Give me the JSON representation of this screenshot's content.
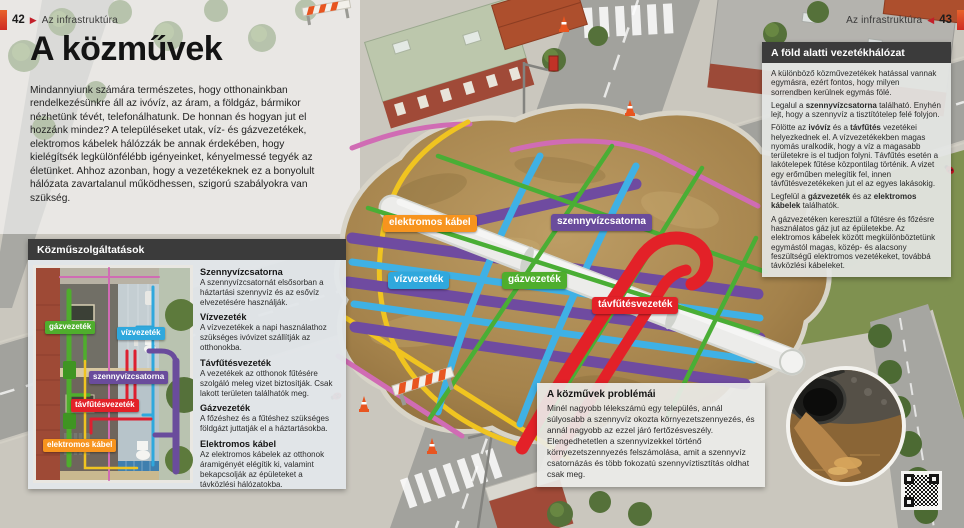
{
  "page": {
    "title": "A közművek",
    "intro": "Mindannyiunk számára természetes, hogy otthonainkban rendelkezésünkre áll az ivóvíz, az áram, a földgáz, bármikor nézhetünk tévét, telefonálhatunk. De honnan és hogyan jut el hozzánk mindez? A településeket utak, víz- és gázvezetékek, elektromos kábelek hálózzák be annak érdekében, hogy kielégítsék legkülönfélébb igényeinket, kényelmessé tegyék az életünket. Ahhoz azonban, hogy a vezetékeknek ez a bonyolult hálózata zavartalanul működhessen, szigorú szabályokra van szükség."
  },
  "header_left": {
    "page_number": "42",
    "section": "Az infrastruktúra"
  },
  "header_right": {
    "section": "Az infrastruktúra",
    "page_number": "43"
  },
  "services_box": {
    "header": "Közműszolgáltatások",
    "house_labels": [
      "gázvezeték",
      "vízvezeték",
      "szennyvízcsatorna",
      "távfűtésvezeték",
      "elektromos kábel"
    ],
    "entries": [
      {
        "term": "Szennyvízcsatorna",
        "description": "A szennyvízcsatornát elsősorban a háztartási szennyvíz és az esővíz elvezetésére használják."
      },
      {
        "term": "Vízvezeték",
        "description": "A vízvezetékek a napi használathoz szükséges ivóvizet szállítják az otthonokba."
      },
      {
        "term": "Távfűtésvezeték",
        "description": "A vezetékek az otthonok fűtésére szolgáló meleg vizet biztosítják. Csak lakott területen találhatók meg."
      },
      {
        "term": "Gázvezeték",
        "description": "A főzéshez és a fűtéshez szükséges földgázt juttatják el a háztartásokba."
      },
      {
        "term": "Elektromos kábel",
        "description": "Az elektromos kábelek az otthonok áramigényét elégítik ki, valamint bekapcsolják az épületeket a távközlési hálózatokba."
      }
    ]
  },
  "scene_labels": [
    {
      "label": "elektromos kábel",
      "color": "#f7941e"
    },
    {
      "label": "szennyvízcsatorna",
      "color": "#6a4c9c"
    },
    {
      "label": "vízvezeték",
      "color": "#2fa8dd"
    },
    {
      "label": "gázvezeték",
      "color": "#4fae2d"
    },
    {
      "label": "távfűtésvezeték",
      "color": "#e32128"
    }
  ],
  "sidebar_box": {
    "header": "A föld alatti vezetékhálózat",
    "paragraphs": [
      [
        {
          "t": "A különböző közművezetékek hatással vannak egymásra, ezért fontos, hogy milyen sorrendben kerülnek egymás fölé."
        }
      ],
      [
        {
          "t": "Legalul a "
        },
        {
          "t": "szennyvízcsatorna",
          "b": true
        },
        {
          "t": " található. Enyhén lejt, hogy a szennyvíz a tisztítótelep felé folyjon."
        }
      ],
      [
        {
          "t": "Fölötte az "
        },
        {
          "t": "ivóvíz",
          "b": true
        },
        {
          "t": " és a "
        },
        {
          "t": "távfűtés",
          "b": true
        },
        {
          "t": " vezetékei helyezkednek el. A vízvezetékekben magas nyomás uralkodik, hogy a víz a magasabb területekre is el tudjon folyni. Távfűtés esetén a lakótelepek fűtése központilag történik. A vizet egy erőműben melegítik fel, innen távfűtésvezetékeken jut el az egyes lakásokig."
        }
      ],
      [
        {
          "t": "Legfelül a "
        },
        {
          "t": "gázvezeték",
          "b": true
        },
        {
          "t": " és az "
        },
        {
          "t": "elektromos kábelek",
          "b": true
        },
        {
          "t": " találhatók."
        }
      ],
      [
        {
          "t": "A gázvezetéken keresztül a fűtésre és főzésre használatos gáz jut az épületekbe. Az elektromos kábelek között megkülönböztetünk egymástól magas, közép- és alacsony feszültségű elektromos vezetékeket, továbbá távközlési kábeleket."
        }
      ]
    ]
  },
  "problems_box": {
    "title": "A közművek problémái",
    "text": "Minél nagyobb lélekszámú egy település, annál súlyosabb a szennyvíz okozta környezetszennyezés, és annál nagyobb az ezzel járó fertőzésveszély. Elengedhetetlen a szennyvizekkel történő környezetszennyezés felszámolása, amit a szennyvíz csatornázás és több fokozatú szennyvíztisztítás oldhat csak meg."
  },
  "colors": {
    "sewage_purple": "#6a4c9c",
    "water_blue": "#2fa8dd",
    "gas_green": "#4fae2d",
    "heating_red": "#e32128",
    "electric_orange": "#f7941e",
    "cable_yellow": "#f0c420",
    "telecom_pink": "#d06cb4",
    "header_bar": "#3b3b3b",
    "accent_red": "#c3202a",
    "soil_brown": "#a8854d"
  }
}
